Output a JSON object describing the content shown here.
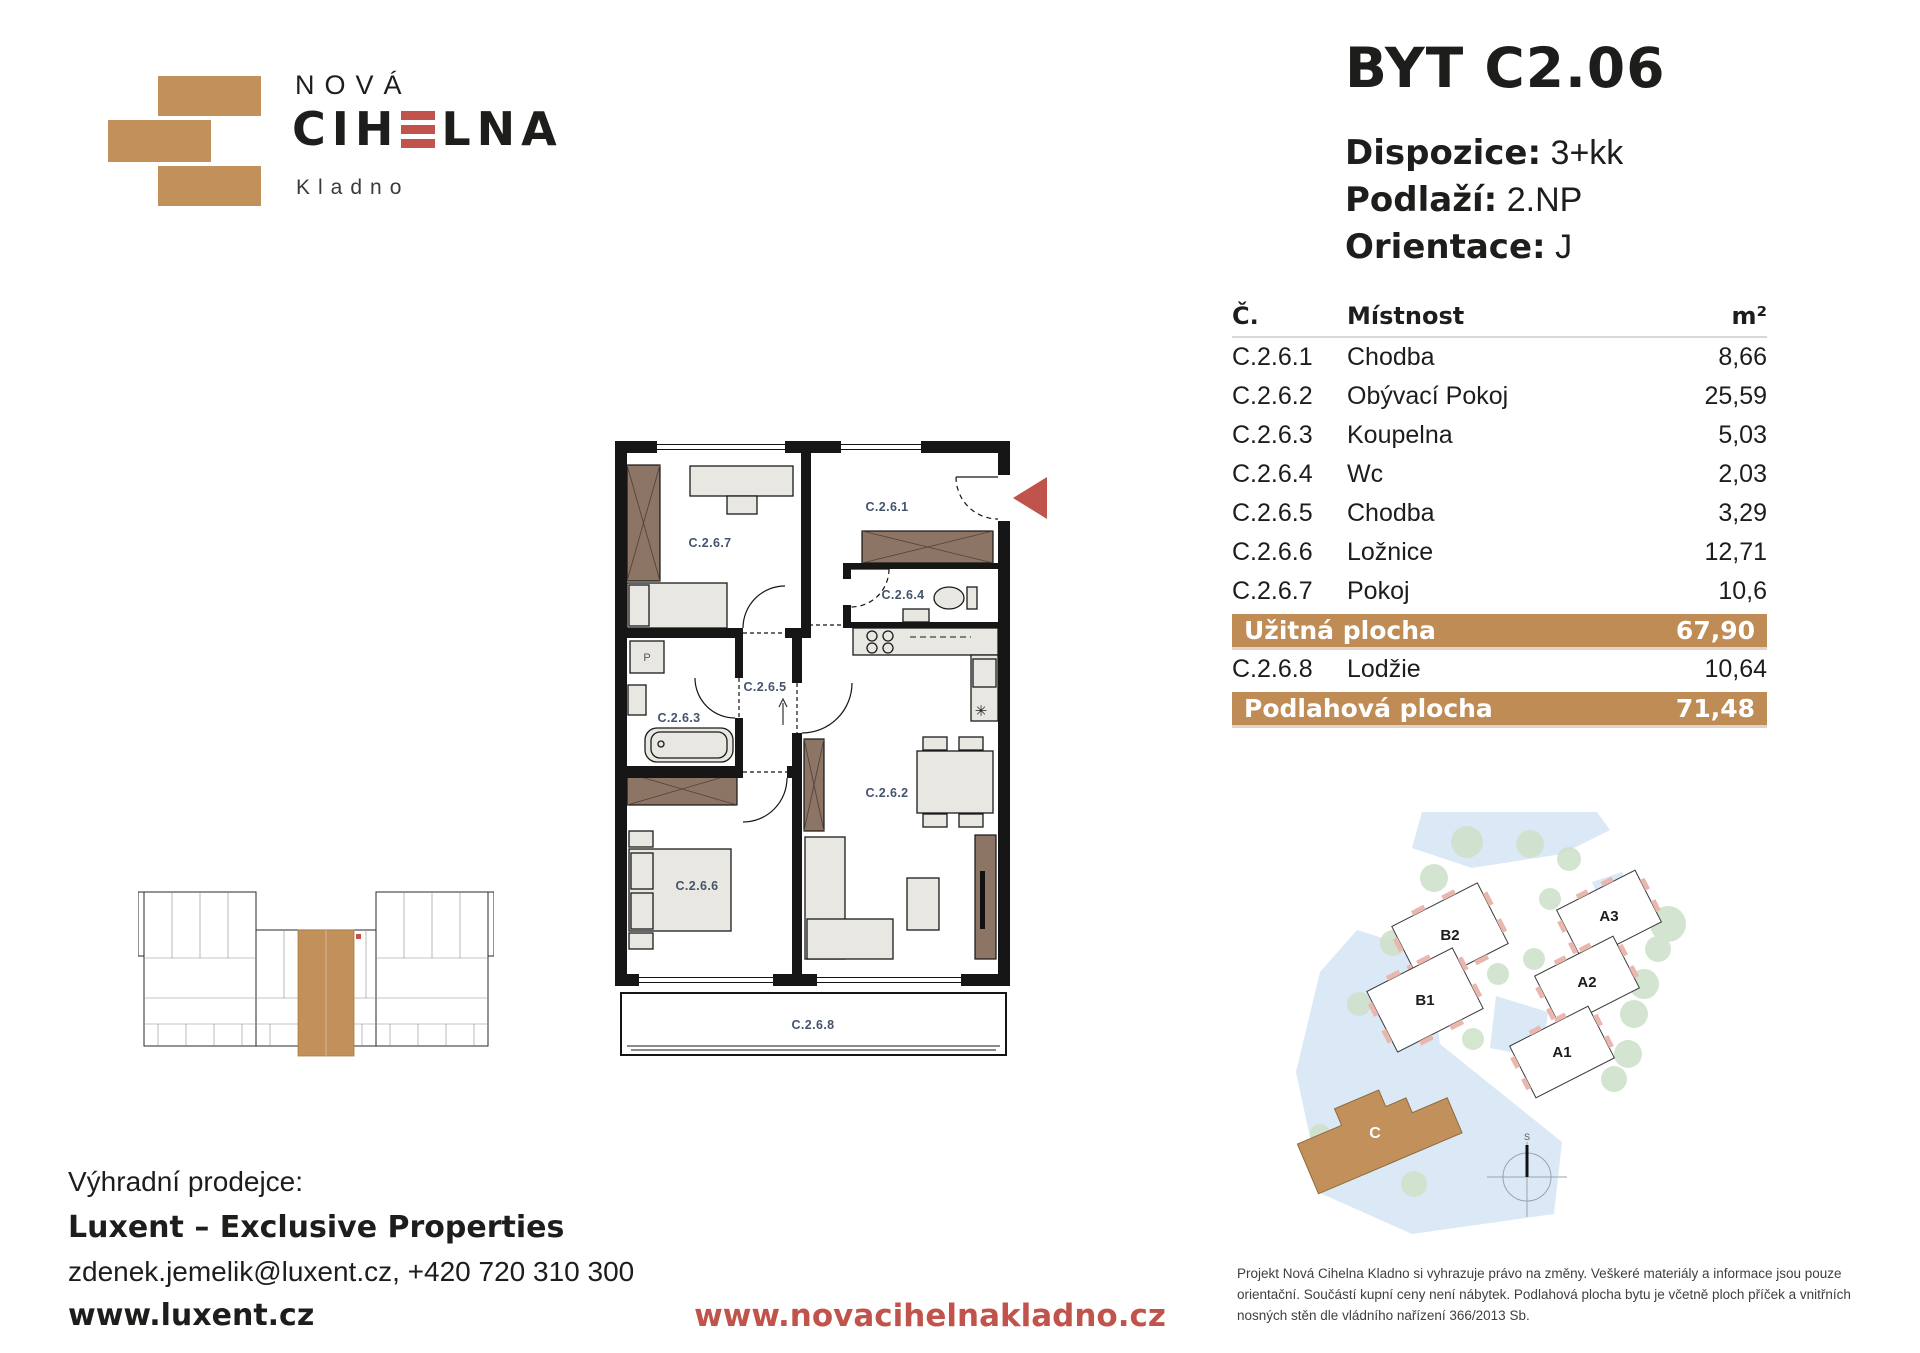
{
  "logo": {
    "line1": "NOVÁ",
    "brand_pre": "CIH",
    "brand_post": "LNA",
    "city": "Kladno"
  },
  "header": {
    "title": "BYT C2.06",
    "specs": [
      {
        "label": "Dispozice:",
        "value": "3+kk"
      },
      {
        "label": "Podlaží:",
        "value": "2.NP"
      },
      {
        "label": "Orientace:",
        "value": "J"
      }
    ]
  },
  "table": {
    "headers": {
      "num": "Č.",
      "room": "Místnost",
      "area": "m²"
    },
    "rows": [
      {
        "num": "C.2.6.1",
        "room": "Chodba",
        "area": "8,66"
      },
      {
        "num": "C.2.6.2",
        "room": "Obývací Pokoj",
        "area": "25,59"
      },
      {
        "num": "C.2.6.3",
        "room": "Koupelna",
        "area": "5,03"
      },
      {
        "num": "C.2.6.4",
        "room": "Wc",
        "area": "2,03"
      },
      {
        "num": "C.2.6.5",
        "room": "Chodba",
        "area": "3,29"
      },
      {
        "num": "C.2.6.6",
        "room": "Ložnice",
        "area": "12,71"
      },
      {
        "num": "C.2.6.7",
        "room": "Pokoj",
        "area": "10,6"
      }
    ],
    "useful_area": {
      "label": "Užitná plocha",
      "value": "67,90"
    },
    "extra_row": {
      "num": "C.2.6.8",
      "room": "Lodžie",
      "area": "10,64"
    },
    "floor_area": {
      "label": "Podlahová plocha",
      "value": "71,48"
    }
  },
  "plan": {
    "rooms": {
      "c1": "C.2.6.1",
      "c2": "C.2.6.2",
      "c3": "C.2.6.3",
      "c4": "C.2.6.4",
      "c5": "C.2.6.5",
      "c6": "C.2.6.6",
      "c7": "C.2.6.7",
      "c8": "C.2.6.8"
    },
    "symbols": {
      "washer": "P",
      "sink": "✳"
    }
  },
  "site": {
    "buildings": [
      "B2",
      "B1",
      "A3",
      "A2",
      "A1"
    ],
    "highlight": "C",
    "compass": "S"
  },
  "footer": {
    "seller_label": "Výhradní prodejce:",
    "seller_name": "Luxent – Exclusive Properties",
    "contact": "zdenek.jemelik@luxent.cz, +420 720 310 300",
    "seller_url": "www.luxent.cz",
    "project_url": "www.novacihelnakladno.cz",
    "disclaimer": "Projekt Nová Cihelna Kladno si vyhrazuje právo na změny. Veškeré materiály a informace jsou pouze orientační. Součástí kupní ceny není nábytek. Podlahová plocha bytu je včetně ploch příček a vnitřních nosných stěn dle vládního nařízení 366/2013 Sb."
  },
  "colors": {
    "brand_tan": "#C2905A",
    "accent_red": "#C0544C",
    "label_blue": "#44546b"
  }
}
